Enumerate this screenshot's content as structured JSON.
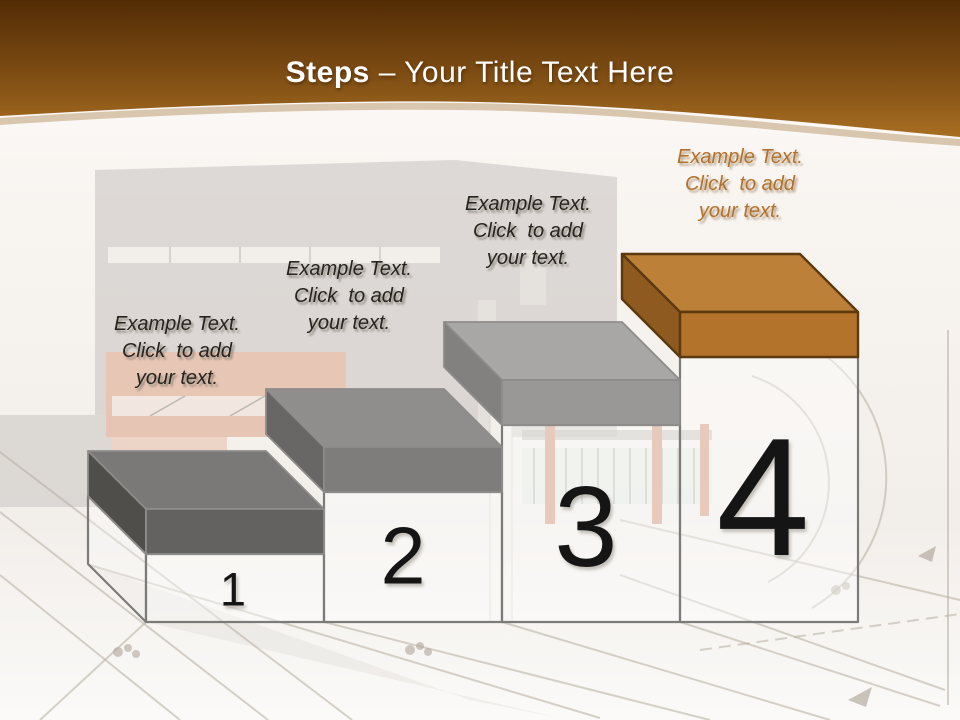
{
  "slide": {
    "title": {
      "emphasis": "Steps",
      "rest": " – Your Title Text Here"
    }
  },
  "steps": [
    {
      "number": "1",
      "label_lines": [
        "Example Text.",
        "Click  to add",
        "your text."
      ],
      "slab_colors": {
        "top": "#7b7977",
        "front": "#636260",
        "side": "#504e4a"
      }
    },
    {
      "number": "2",
      "label_lines": [
        "Example Text.",
        "Click  to add",
        "your text."
      ],
      "slab_colors": {
        "top": "#908e8c",
        "front": "#7f7d7b",
        "side": "#696765"
      }
    },
    {
      "number": "3",
      "label_lines": [
        "Example Text.",
        "Click  to add",
        "your text."
      ],
      "slab_colors": {
        "top": "#a9a7a5",
        "front": "#9a9896",
        "side": "#838180"
      }
    },
    {
      "number": "4",
      "label_lines": [
        "Example Text.",
        "Click  to add",
        "your text."
      ],
      "slab_colors": {
        "top": "#bc8038",
        "front": "#b4732a",
        "side": "#8e5a20"
      }
    }
  ],
  "colors": {
    "header_gradient_top": "#532c05",
    "header_gradient_mid": "#7a4a12",
    "header_gradient_bottom": "#a86e22",
    "page_background": "#f8f4f0",
    "title_text": "#ffffff",
    "label_text": "#26241f",
    "step4_label_accent": "#b1722c",
    "number_text": "#151515",
    "box_outline": "#7d7b79",
    "step4_outline": "#5c390f"
  }
}
